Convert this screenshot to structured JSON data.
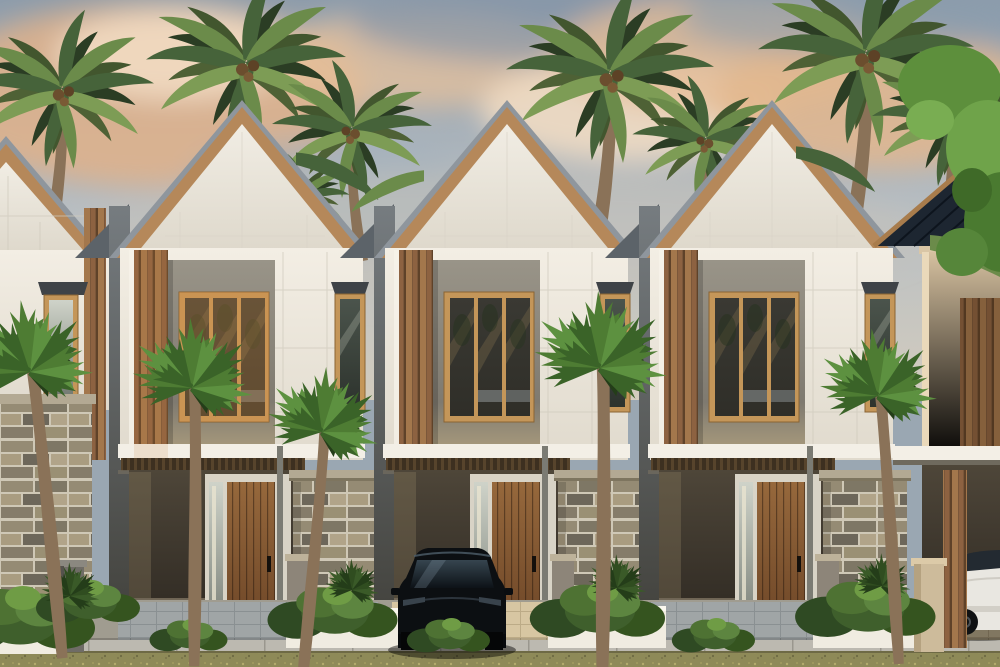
{
  "scene": {
    "alt_text": "3D architectural rendering of a row of modern two-storey tropical townhouses at sunset: white panel facades with timber slat accents, steep gable roofs with wood fascia, tall three-pane timber windows, narrow awning windows, stone fence walls with white planters, coconut palms behind and fan palms in front, a black SUV parked in the centre carport and a white car at the far right.",
    "time_of_day": "sunset with peach clouds over blue-gray sky",
    "full_units_visible": 3,
    "partial_units_visible": 2,
    "vehicles": [
      "black SUV in centre carport",
      "white car in far-right carport"
    ]
  },
  "colors": {
    "sky_top": "#8d9cab",
    "sky_mid": "#b9bfc3",
    "sky_low": "#d3ccbe",
    "cloud_peach": "#e0b18a",
    "cloud_cream": "#f2dcc3",
    "cloud_slate": "#8496a8",
    "roof_metal": "#8f969d",
    "roof_wood": "#b5885a",
    "roof_navy": "#1d2631",
    "wall_light": "#f3eee4",
    "wall_shade": "#e0dacd",
    "panel_gray": "#928d83",
    "window_frame": "#c49659",
    "glass_dark": "#2f2e28",
    "glass_warm_tint": "#d89144",
    "awning_gray": "#3f4347",
    "slat_light": "#a3774c",
    "slat_dark": "#7b573a",
    "slab_white": "#f3efe6",
    "carport_dark": "#2a251f",
    "door_wood": "#8a5c34",
    "door_frame": "#d8d3c6",
    "stone_block": "#958b74",
    "stone_joint": "#cfc8b6",
    "stone_cap": "#b3a993",
    "post_gray": "#8d8579",
    "pillar_beige": "#cdbb9b",
    "planter_white": "#f0ece1",
    "palm_green": "#6b8b4a",
    "palm_dark": "#46633a",
    "palm_bright": "#4e7c33",
    "trunk_brown": "#8a7258",
    "shrub_dark": "#2f4a23",
    "shrub_mid": "#3f5f2c",
    "shrub_light": "#5d8540",
    "grass": "#8e8a58",
    "sidewalk": "#bcb9b0",
    "paver_cool": "#a0a5a6",
    "paver_warm": "#d7c6a2",
    "floor_warm": "#cfc5ac",
    "car_black": "#0c0f12",
    "car_glass": "#36454f",
    "car_white": "#e9e7e1",
    "beige_wall": "#d6c1a0"
  }
}
